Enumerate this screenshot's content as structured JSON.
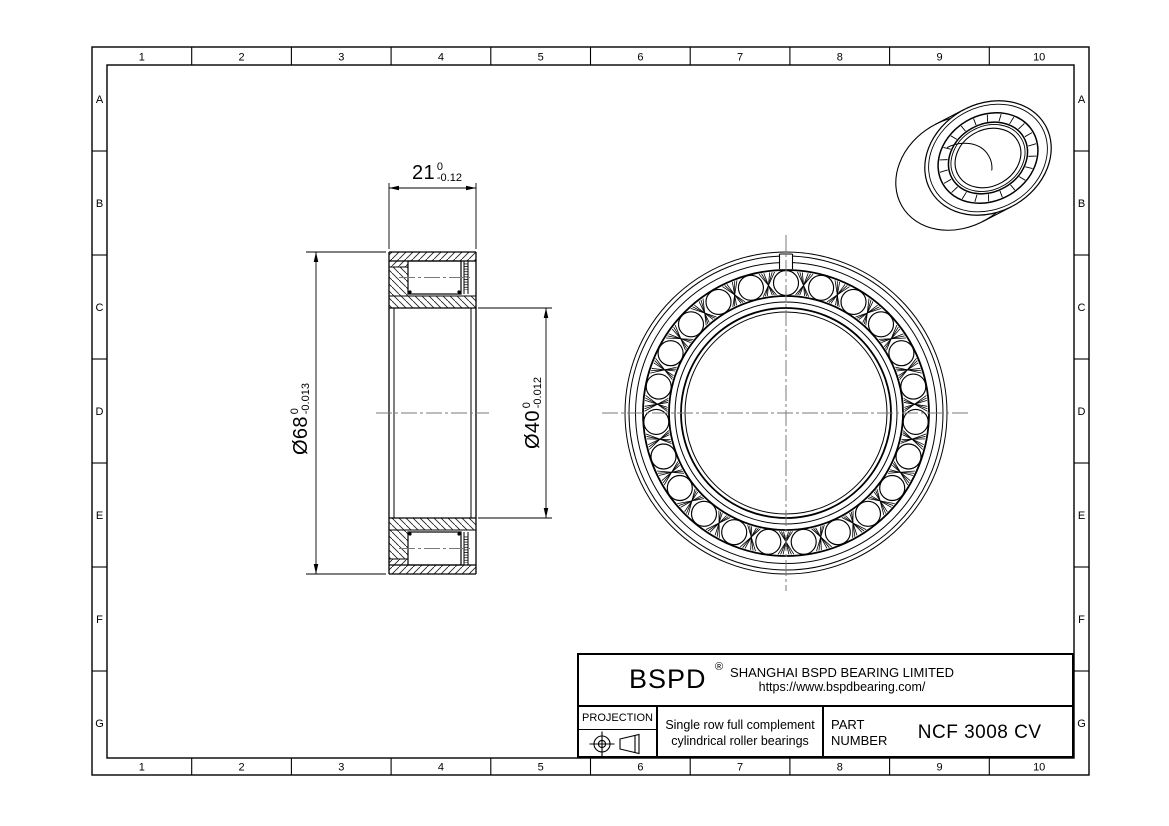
{
  "page": {
    "background": "#ffffff",
    "line_color": "#000000",
    "centerline_color": "#787878",
    "hatch_color": "#222222"
  },
  "border": {
    "columns": [
      "1",
      "2",
      "3",
      "4",
      "5",
      "6",
      "7",
      "8",
      "9",
      "10"
    ],
    "rows": [
      "A",
      "B",
      "C",
      "D",
      "E",
      "F",
      "G"
    ]
  },
  "dimensions": {
    "width": {
      "value": "21",
      "tol_upper": "0",
      "tol_lower": "-0.12"
    },
    "outer_diameter": {
      "value": "Ø68",
      "tol_upper": "0",
      "tol_lower": "-0.013"
    },
    "bore_diameter": {
      "value": "Ø40",
      "tol_upper": "0",
      "tol_lower": "-0.012"
    }
  },
  "views": {
    "front": {
      "roller_count": 23
    },
    "iso": {
      "roller_tick_count": 22
    }
  },
  "title_block": {
    "brand": "BSPD",
    "registered_mark": "®",
    "company": "SHANGHAI BSPD BEARING LIMITED",
    "website": "https://www.bspdbearing.com/",
    "projection_label": "PROJECTION",
    "description": [
      "Single row full complement",
      "cylindrical roller bearings"
    ],
    "part_number_label": [
      "PART",
      "NUMBER"
    ],
    "part_number": "NCF 3008 CV"
  }
}
